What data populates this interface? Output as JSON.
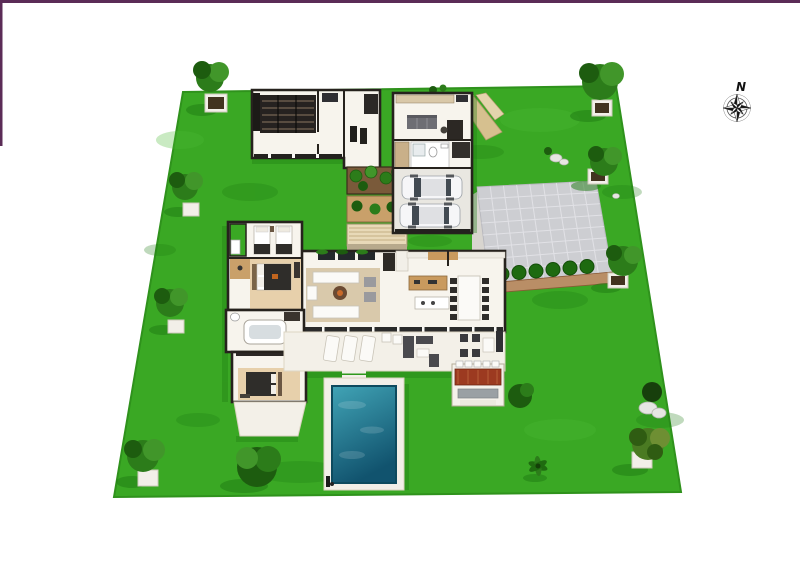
{
  "page": {
    "width": 800,
    "height": 566,
    "background": "#ffffff"
  },
  "frame": {
    "border_color": "#5b2c57"
  },
  "compass": {
    "label": "N",
    "icon": "compass-rose-icon"
  },
  "scene": {
    "kind": "3d-rendered-floor-plan",
    "elements": [
      "garden-lawn",
      "villa-floor-plan",
      "garage-two-cars",
      "inner-courtyard",
      "living-room",
      "dining-room",
      "kitchen",
      "bedrooms",
      "bathrooms",
      "terrace-with-loungers",
      "swimming-pool",
      "outdoor-dining-pergola",
      "paved-driveway",
      "trees-in-planters",
      "rocks",
      "compass-rose"
    ]
  },
  "palette": {
    "grass": "#3aa824",
    "grass_dark": "#1e7a11",
    "lawn_edge": "#2f921c",
    "wall": "#26221d",
    "wall_face": "#efe6d0",
    "floor": "#f7f4ed",
    "floor_warm": "#e7d0ab",
    "rug": "#d9c9ab",
    "deck": "#f3f0e8",
    "pool_shallow": "#41a4b6",
    "pool_deep": "#11536e",
    "pool_edge": "#0d4a5e",
    "pool_deck": "#f2efe8",
    "driveway": "#cdced2",
    "driveway_line": "#e4e4e8",
    "paver": "#b98e66",
    "soil": "#7a5a3a",
    "soil_dark": "#42331f",
    "bed_tan": "#c9a06a",
    "bush": "#2c7c1a",
    "bush_dark": "#1d5c0f",
    "foliage_light": "#41962a",
    "wood": "#c99a5e",
    "pergola_table": "#9c3a20",
    "bench_gray": "#9aa0a4",
    "furniture_dark": "#2f2d2a",
    "sofa_gray": "#6e6e74",
    "white": "#fbfaf7",
    "path_tan": "#d6c08f",
    "rock": "#e6e6e2",
    "car_body": "#f6f6f8",
    "car_glass": "#424a52",
    "car_roof": "#dfe0e3",
    "garage_floor": "#e9e7e1",
    "ink": "#111111"
  }
}
